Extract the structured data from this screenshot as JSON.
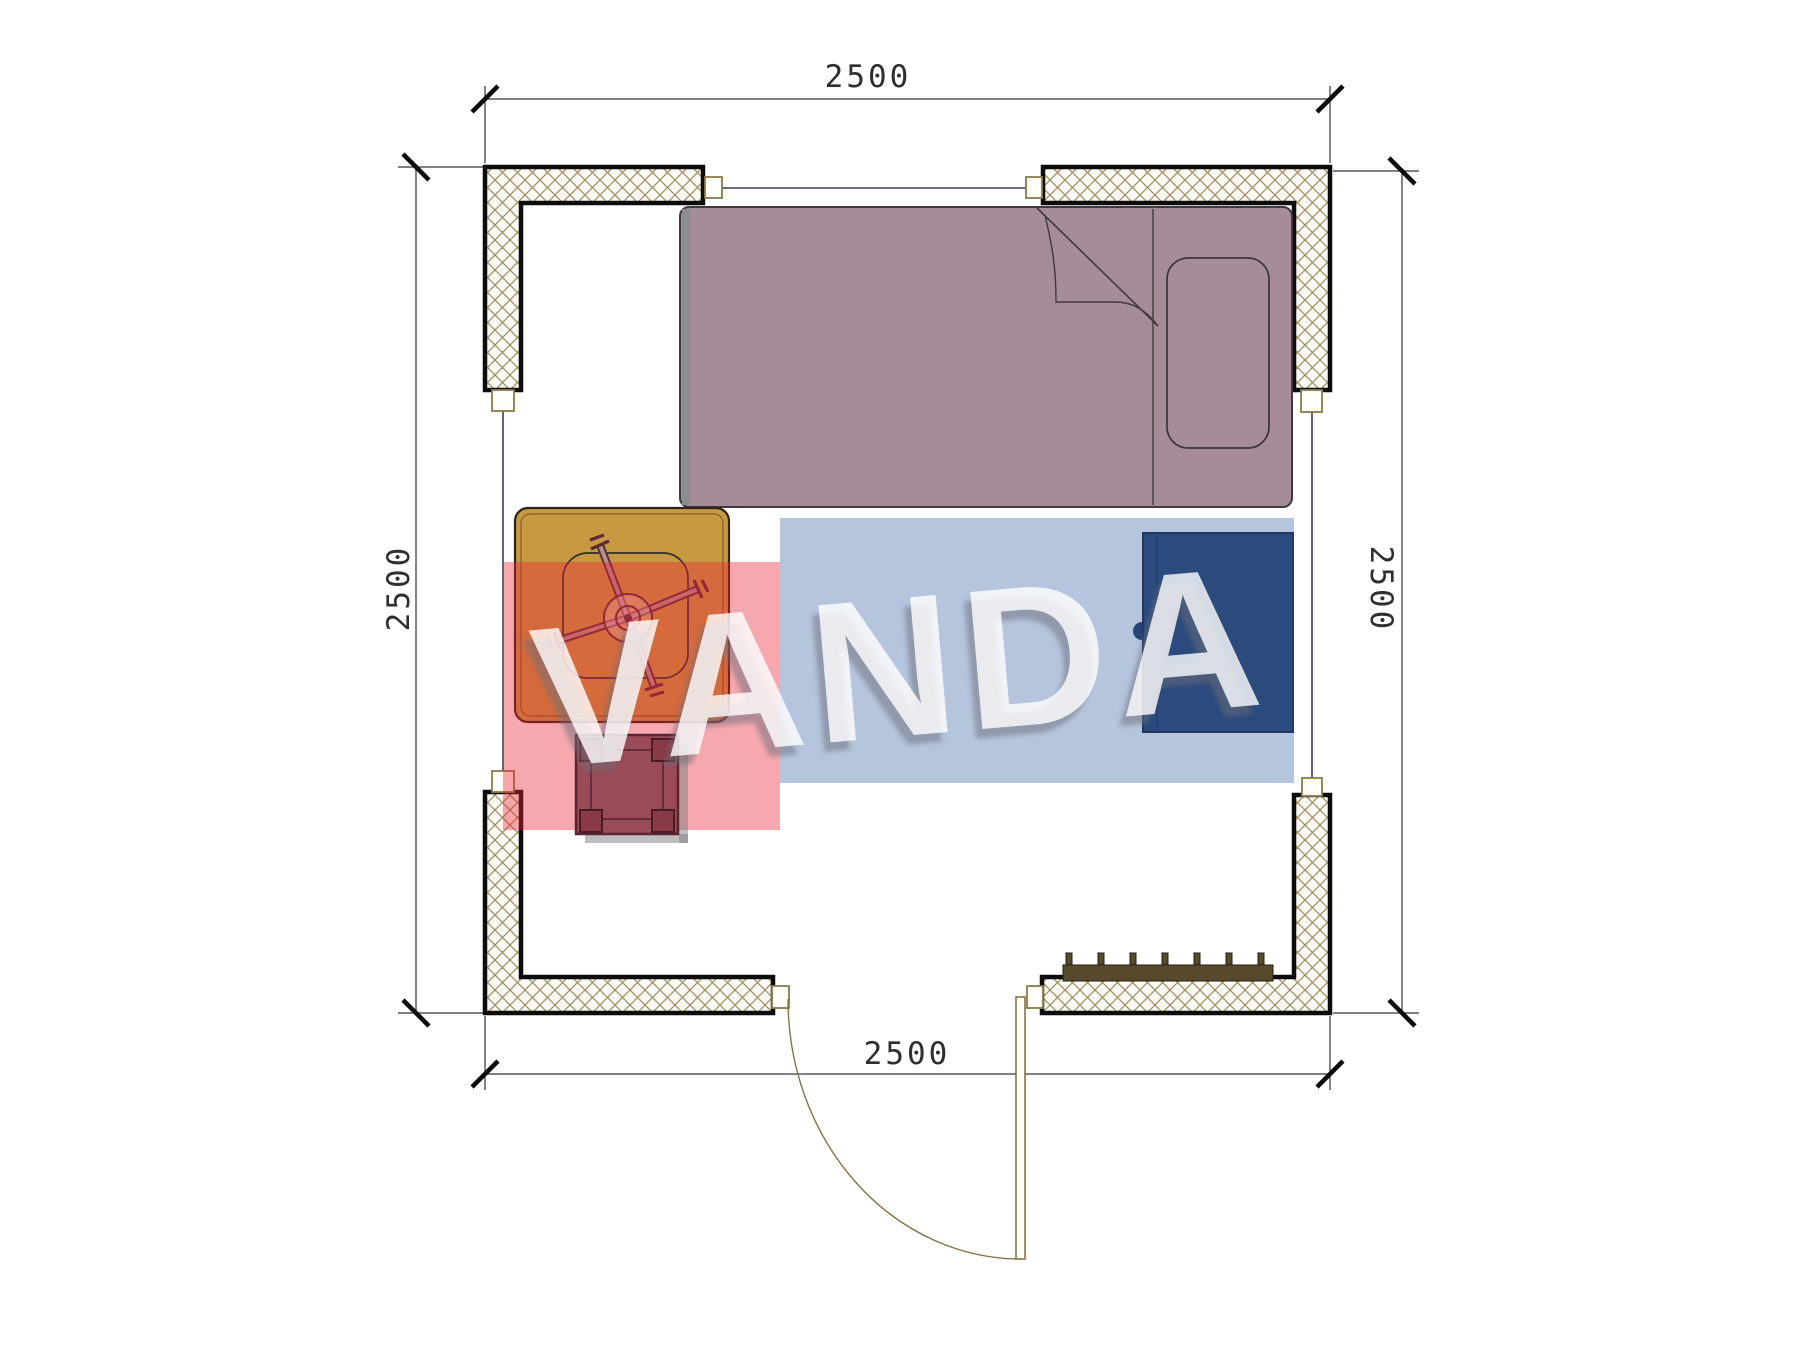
{
  "plan": {
    "title": "room-floor-plan-2500x2500",
    "watermark_text": "VANDA",
    "dim_top": "2500",
    "dim_bottom": "2500",
    "dim_left": "2500",
    "dim_right": "2500"
  },
  "elements": {
    "wall_hatch_line": "#9c8c60",
    "wall_outline": "#0d0d0d",
    "bed_fill": "#a48d98",
    "table_fill": "#c79a42",
    "stool_fill": "#9a4b59",
    "wardrobe_fill": "#1a3260",
    "radiator_fill": "#574a2c",
    "door_stroke": "#85744a",
    "window_line": "#3c3c58",
    "dimension_line": "#33333a",
    "watermark_pink_block": "rgba(236,38,56,0.40)",
    "watermark_blue_block": "rgba(70,110,170,0.40)",
    "watermark_text_color": "rgba(255,255,255,0.80)"
  }
}
